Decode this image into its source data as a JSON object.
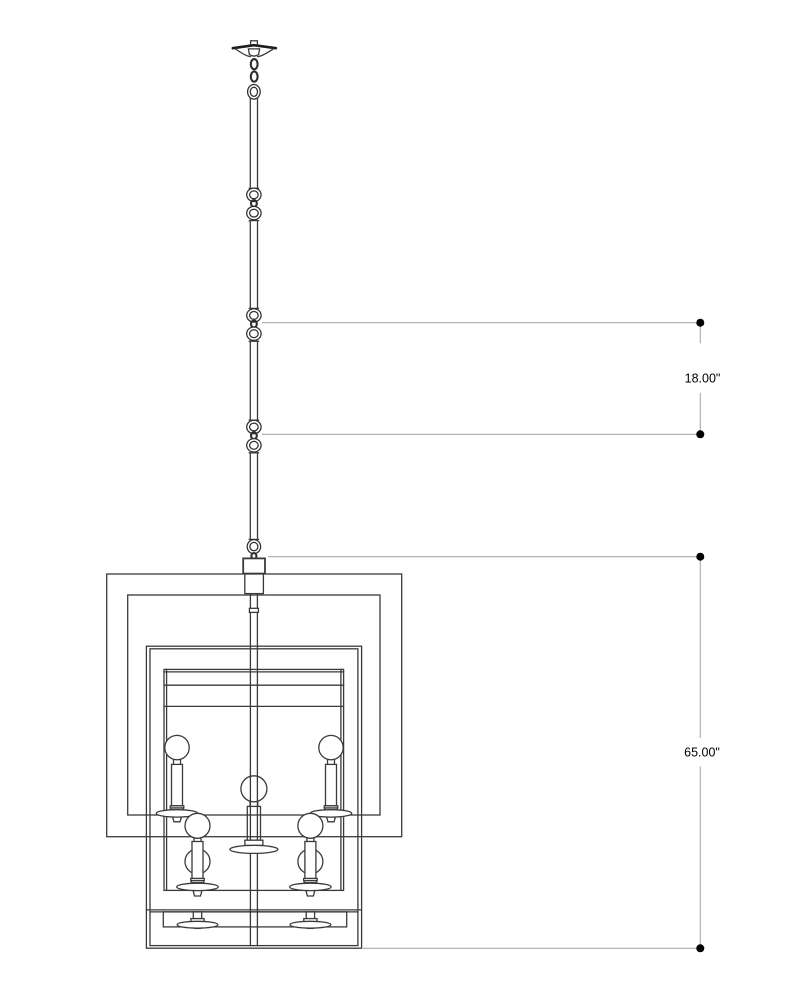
{
  "page": {
    "background": "#ffffff",
    "description": "Technical elevation line drawing of a square double-cage chandelier hung on a rod with chain joints, annotated with two vertical dimensions on the right side"
  },
  "drawing": {
    "type": "chandelier-elevation",
    "parts": [
      "ceiling-canopy",
      "chain-links",
      "hanging-rod",
      "rod-joints",
      "hang-loop",
      "mounting-block",
      "outer-frame",
      "middle-frame",
      "inner-shade",
      "center-stem",
      "upper-tier-bulbs",
      "center-bulb",
      "lower-tier-bulbs",
      "bottom-tier-sockets"
    ]
  },
  "dimensions": {
    "rod_section": {
      "label": "18.00\"",
      "value": 18.0,
      "unit": "in"
    },
    "fixture_drop": {
      "label": "65.00\"",
      "value": 65.0,
      "unit": "in"
    }
  },
  "colors": {
    "drawing_line": "#3a3a3a",
    "dimension_line": "#a9a9a9",
    "dimension_marker": "#000000",
    "dimension_text": "#000000",
    "background": "#ffffff"
  }
}
